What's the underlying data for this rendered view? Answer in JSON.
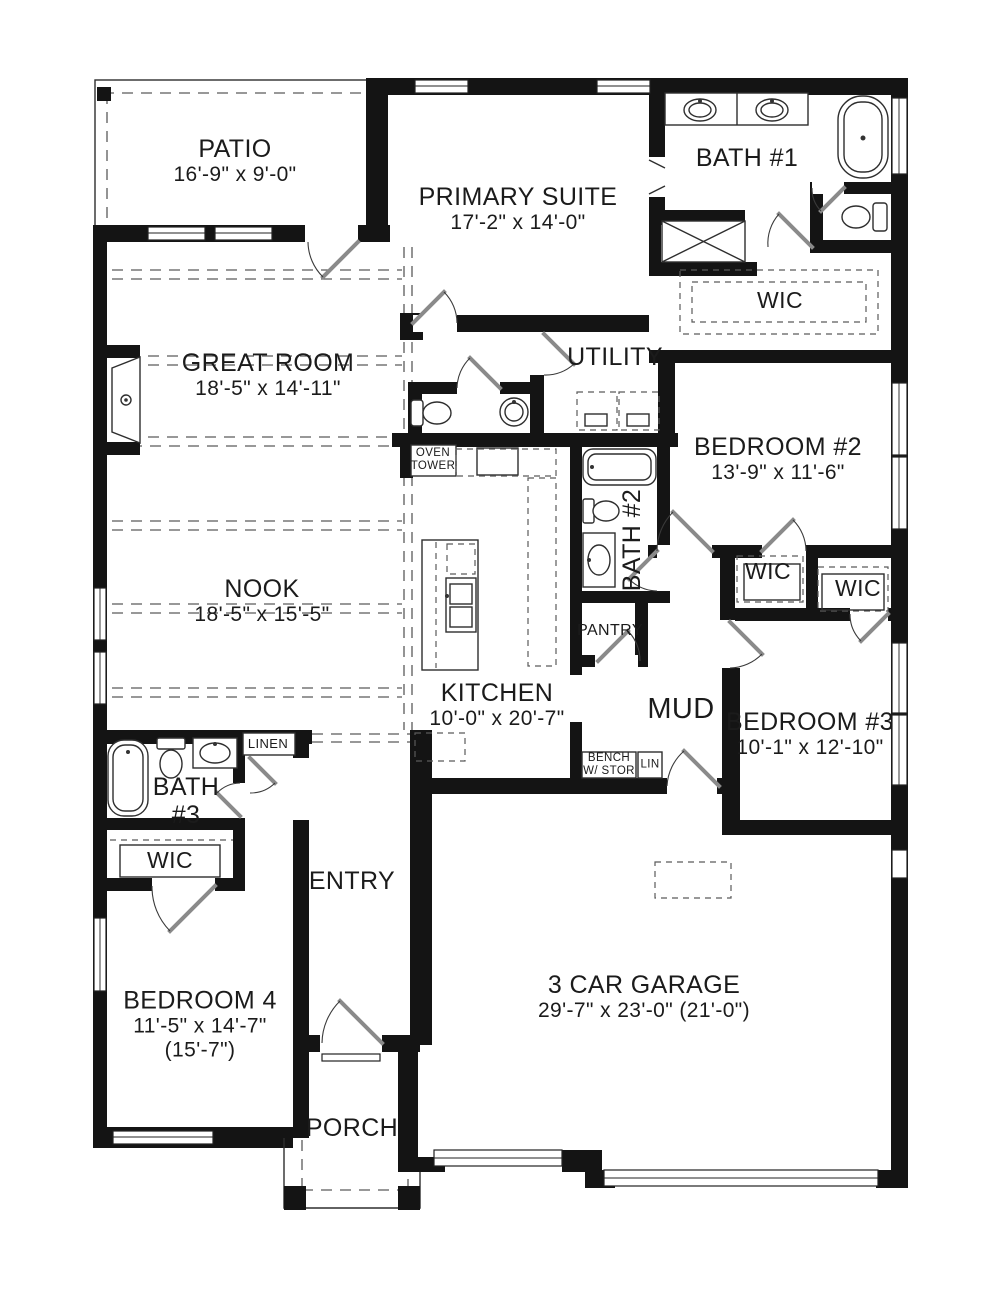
{
  "title": "Single-story floor plan",
  "colors": {
    "wall": "#141414",
    "line": "#2e2e2e",
    "dash": "#5a5a5a",
    "door_leaf": "#8a8a8a",
    "background": "#ffffff",
    "text": "#1b1b1b"
  },
  "rooms": {
    "patio": {
      "name": "PATIO",
      "dims": "16'-9\" x 9'-0\""
    },
    "primary_suite": {
      "name": "PRIMARY SUITE",
      "dims": "17'-2\" x 14'-0\""
    },
    "bath_1": {
      "name": "BATH #1"
    },
    "primary_wic": {
      "name": "WIC"
    },
    "great_room": {
      "name": "GREAT ROOM",
      "dims": "18'-5\" x 14'-11\""
    },
    "utility": {
      "name": "UTILITY"
    },
    "bedroom_2": {
      "name": "BEDROOM #2",
      "dims": "13'-9\" x 11'-6\""
    },
    "bath_2": {
      "name": "BATH #2"
    },
    "nook": {
      "name": "NOOK",
      "dims": "18'-5\" x 15'-5\""
    },
    "kitchen": {
      "name": "KITCHEN",
      "dims": "10'-0\" x 20'-7\""
    },
    "oven_tower": {
      "line1": "OVEN",
      "line2": "TOWER"
    },
    "pantry": {
      "name": "PANTRY"
    },
    "mud": {
      "name": "MUD"
    },
    "bedroom_3": {
      "name": "BEDROOM #3",
      "dims": "10'-1\" x 12'-10\""
    },
    "wic_bedroom_2": {
      "name": "WIC"
    },
    "wic_bedroom_3": {
      "name": "WIC"
    },
    "bath_3": {
      "line1": "BATH",
      "line2": "#3"
    },
    "linen": {
      "name": "LINEN"
    },
    "wic_bedroom_4": {
      "name": "WIC"
    },
    "entry": {
      "name": "ENTRY"
    },
    "bench": {
      "line1": "BENCH",
      "line2": "W/ STOR"
    },
    "lin": {
      "name": "LIN"
    },
    "bedroom_4": {
      "name": "BEDROOM 4",
      "dims": "11'-5\" x 14'-7\"",
      "extra": "(15'-7\")"
    },
    "garage": {
      "name": "3 CAR GARAGE",
      "dims": "29'-7\" x 23'-0\" (21'-0\")"
    },
    "porch": {
      "name": "PORCH"
    }
  }
}
